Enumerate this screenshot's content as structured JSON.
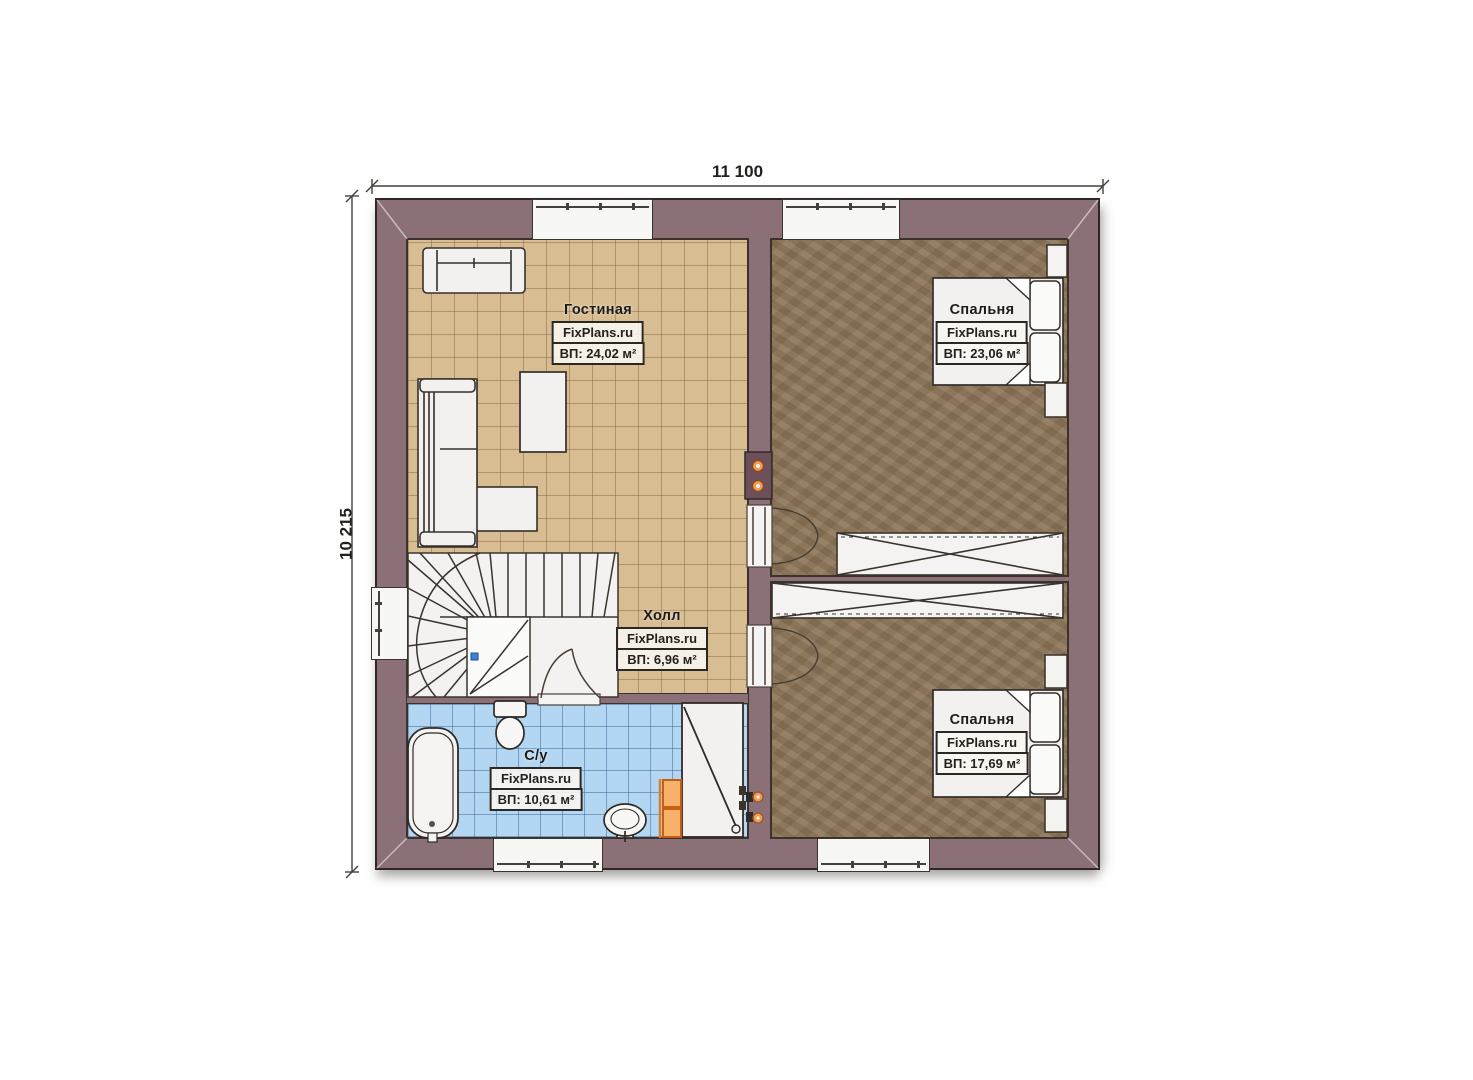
{
  "page": {
    "type": "architectural-floor-plan"
  },
  "dimensions": {
    "width": "11 100",
    "height": "10 215"
  },
  "branding": {
    "watermark": "FixPlans.ru"
  },
  "rooms": [
    {
      "id": "living-room",
      "name": "Гостиная",
      "brand": "FixPlans.ru",
      "area": "ВП: 24,02 м²"
    },
    {
      "id": "bedroom-top",
      "name": "Спальня",
      "brand": "FixPlans.ru",
      "area": "ВП: 23,06 м²"
    },
    {
      "id": "hall",
      "name": "Холл",
      "brand": "FixPlans.ru",
      "area": "ВП: 6,96 м²"
    },
    {
      "id": "bathroom",
      "name": "С/у",
      "brand": "FixPlans.ru",
      "area": "ВП: 10,61 м²"
    },
    {
      "id": "bedroom-bottom",
      "name": "Спальня",
      "brand": "FixPlans.ru",
      "area": "ВП: 17,69 м²"
    }
  ],
  "colors": {
    "wall": "#8b7077",
    "wall-outline": "#2d2823",
    "floor-living": "#d8bc92",
    "floor-bedroom": "#8d7557",
    "floor-bath": "#b3d7f2",
    "furniture": "#f2f1ef",
    "accent-orange": "#f09a52",
    "dimension-text": "#23211e"
  }
}
